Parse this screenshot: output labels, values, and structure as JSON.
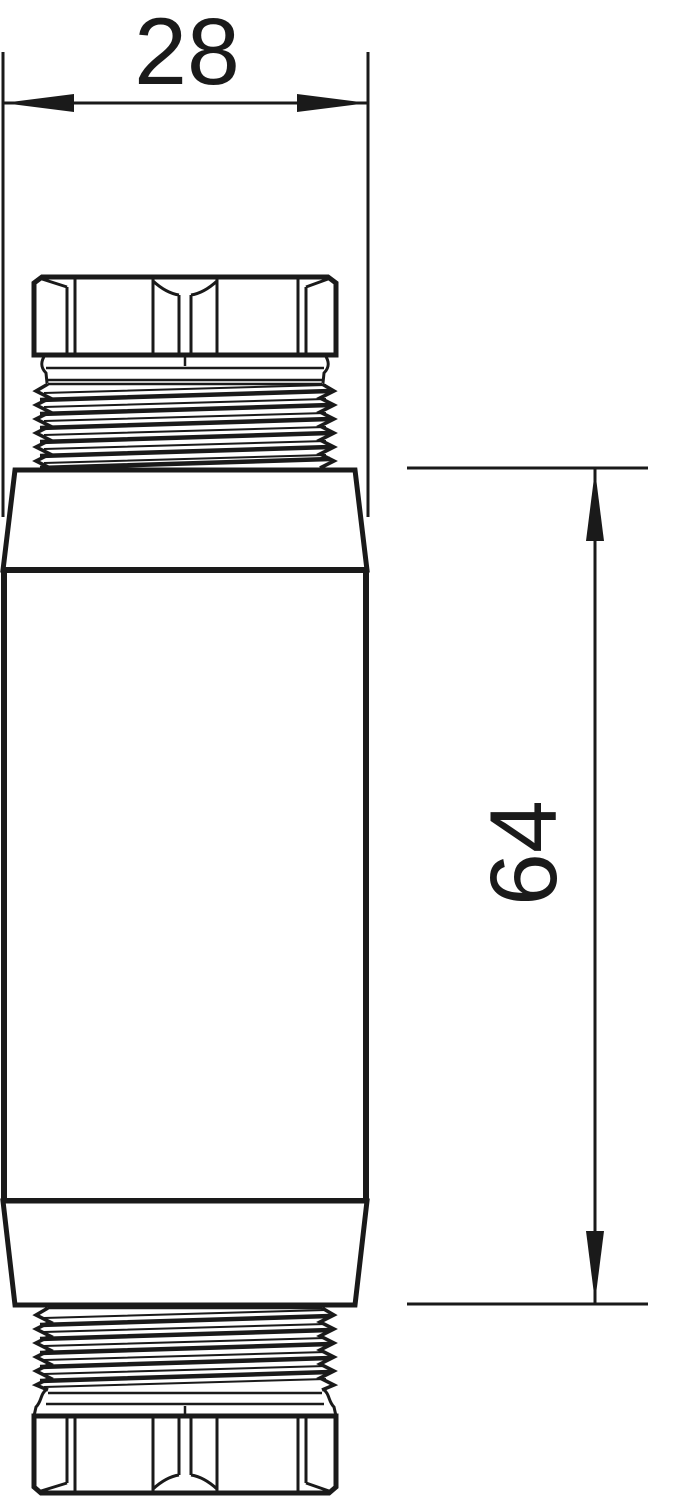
{
  "canvas": {
    "width": 682,
    "height": 1499,
    "background": "#ffffff",
    "ink": "#1a1a1a"
  },
  "drawing": {
    "kind": "technical line drawing, side elevation",
    "subject": "threaded coupler fitting with hex nuts on both ends",
    "dimensions": {
      "width": {
        "value": "28",
        "orientation": "horizontal",
        "position": "top"
      },
      "length": {
        "value": "64",
        "orientation": "vertical",
        "position": "right"
      }
    }
  }
}
